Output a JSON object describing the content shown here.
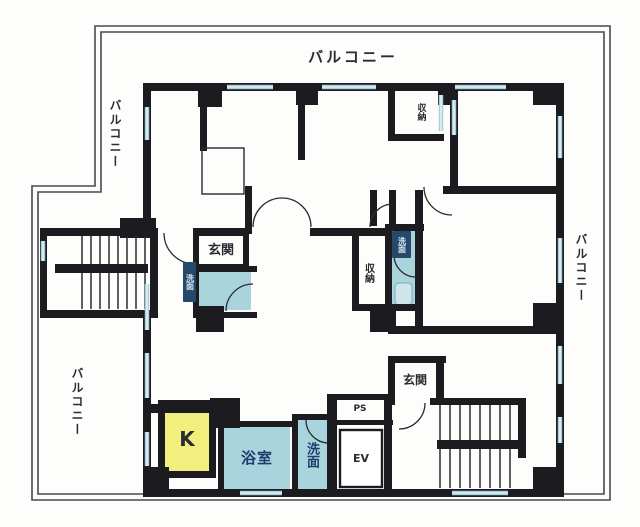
{
  "plan": {
    "type": "floor-plan",
    "labels": {
      "balcony_top": "バルコニー",
      "balcony_left_top": "バルコニー",
      "balcony_right": "バルコニー",
      "balcony_left_bottom": "バルコニー",
      "entrance_upper": "玄関",
      "entrance_lower": "玄関",
      "storage_top_right": "収納",
      "storage_middle": "収納",
      "washroom_upper": "洗面",
      "washroom_left": "洗面",
      "kitchen": "K",
      "bathroom": "浴室",
      "washroom_lower": "洗面",
      "pipe_space": "PS",
      "elevator": "EV"
    },
    "colors": {
      "wall": "#1b1b20",
      "boundary": "#4a4a4f",
      "window": "#a9cfdd",
      "wet": "#aad4dd",
      "kitchen": "#f3ef7e",
      "tag": "#24496b",
      "text": "#2b2b33",
      "wet_text": "#1c3e6e"
    }
  }
}
